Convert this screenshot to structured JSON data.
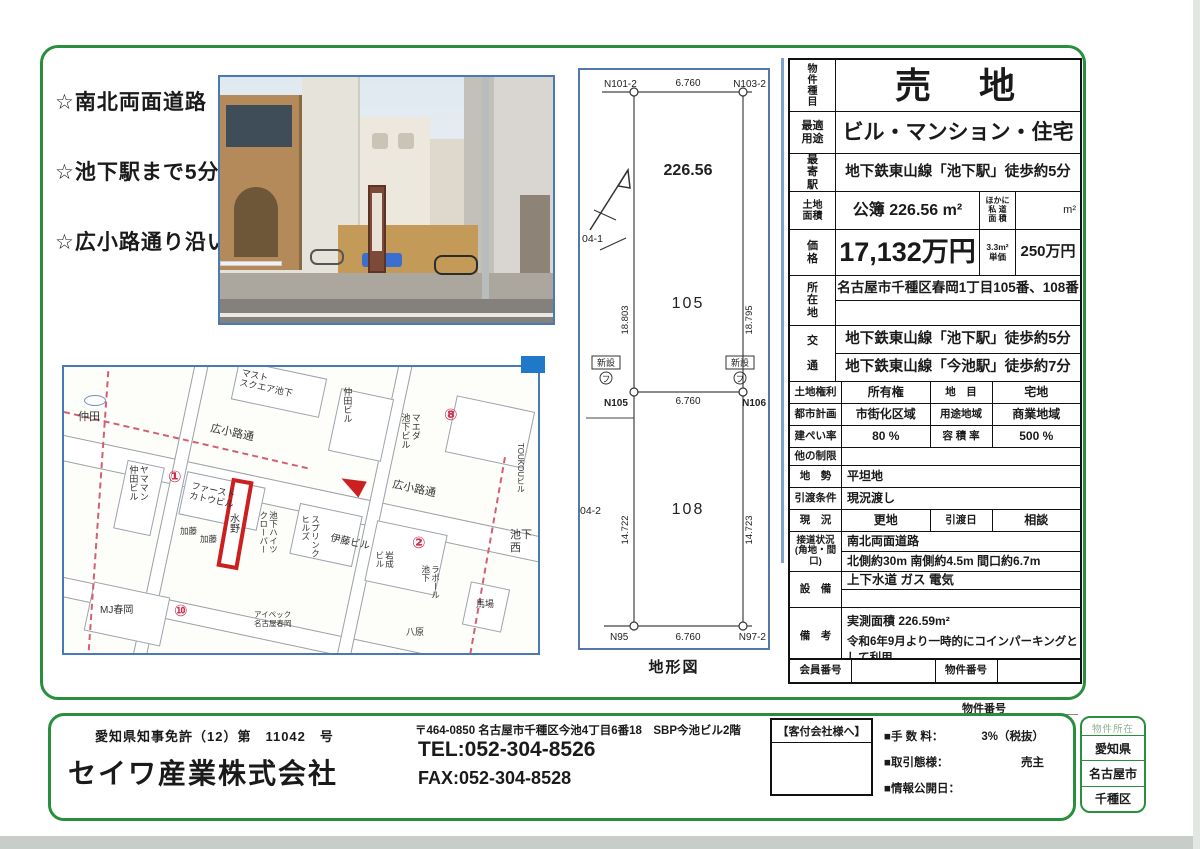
{
  "features": [
    "☆南北両面道路",
    "☆池下駅まで5分",
    "☆広小路通り沿い"
  ],
  "diagram": {
    "caption": "地形図",
    "area": "226.56",
    "lot1": "105",
    "lot2": "108",
    "n_tl": "N101-2",
    "n_tr": "N103-2",
    "n_ml": "N105",
    "n_mr": "N106",
    "n_bl": "N95",
    "n_br": "N97-2",
    "w_top": "6.760",
    "w_mid": "6.760",
    "w_bot": "6.760",
    "l1_left": "18.803",
    "l1_right": "18.795",
    "l2_left": "14.722",
    "l2_right": "14.723",
    "blk1": "04-1",
    "blk2": "04-2",
    "new1": "新設",
    "new2": "新設",
    "fu": "フ"
  },
  "map": {
    "labels": [
      {
        "t": "仲田",
        "x": 14,
        "y": 44,
        "fs": 11
      },
      {
        "t": "マスト\nスクエア池下",
        "x": 176,
        "y": 6,
        "r": 12,
        "fs": 9
      },
      {
        "t": "広小路通",
        "x": 146,
        "y": 60,
        "r": 12,
        "fs": 11
      },
      {
        "t": "仲田ビル",
        "x": 278,
        "y": 20,
        "v": 1,
        "fs": 9
      },
      {
        "t": "マエダ\n池下ビル",
        "x": 336,
        "y": 46,
        "v": 1,
        "fs": 9
      },
      {
        "t": "⑧",
        "x": 380,
        "y": 40,
        "red": 1,
        "fs": 16
      },
      {
        "t": "TOUKOUビル",
        "x": 452,
        "y": 76,
        "v": 1,
        "fs": 8
      },
      {
        "t": "広小路通",
        "x": 328,
        "y": 116,
        "r": 12,
        "fs": 11
      },
      {
        "t": "ヤママン\n仲田ビル",
        "x": 64,
        "y": 98,
        "v": 1,
        "fs": 9
      },
      {
        "t": "①",
        "x": 104,
        "y": 102,
        "red": 1,
        "fs": 16
      },
      {
        "t": "ファースト\nカトウビル",
        "x": 126,
        "y": 118,
        "r": 12,
        "fs": 9
      },
      {
        "t": "水野",
        "x": 163,
        "y": 146,
        "v": 1,
        "fs": 10
      },
      {
        "t": "池下ハイツ\nクローバー",
        "x": 194,
        "y": 144,
        "v": 1,
        "fs": 8.5
      },
      {
        "t": "スプリンク\nヒルズ",
        "x": 236,
        "y": 148,
        "v": 1,
        "fs": 8.5
      },
      {
        "t": "加藤",
        "x": 116,
        "y": 160,
        "fs": 8.5
      },
      {
        "t": "加藤",
        "x": 136,
        "y": 168,
        "fs": 8.5
      },
      {
        "t": "伊藤ビル",
        "x": 266,
        "y": 170,
        "r": 12,
        "fs": 10
      },
      {
        "t": "岩成\nビル",
        "x": 310,
        "y": 184,
        "v": 1,
        "fs": 8.5
      },
      {
        "t": "②",
        "x": 348,
        "y": 168,
        "red": 1,
        "fs": 16
      },
      {
        "t": "ラポール\n池下",
        "x": 356,
        "y": 198,
        "v": 1,
        "fs": 8.5
      },
      {
        "t": "池下西",
        "x": 446,
        "y": 162,
        "fs": 11
      },
      {
        "t": "馬場",
        "x": 412,
        "y": 232,
        "fs": 9
      },
      {
        "t": "MJ春岡",
        "x": 36,
        "y": 238,
        "fs": 10
      },
      {
        "t": "⑩",
        "x": 110,
        "y": 236,
        "red": 1,
        "fs": 16
      },
      {
        "t": "アイペック\n名古屋春岡",
        "x": 190,
        "y": 244,
        "fs": 7.5
      },
      {
        "t": "八原",
        "x": 342,
        "y": 260,
        "fs": 9
      }
    ]
  },
  "spec": {
    "type_label": "物\n件\n種\n目",
    "type": "売　地",
    "use_label": "最適\n用途",
    "use": "ビル・マンション・住宅",
    "station_label": "最\n寄\n駅",
    "station": "地下鉄東山線「池下駅」徒歩約5分",
    "area_label": "土地\n面積",
    "area": "公簿 226.56 m²",
    "area_sub_label": "ほかに\n私 道\n面 積",
    "area_sub": "m²",
    "price_label": "価\n格",
    "price": "17,132万円",
    "unit_label": "3.3m²\n単価",
    "unit_price": "250万円",
    "addr_label": "所\n在\n地",
    "addr": "名古屋市千種区春岡1丁目105番、108番",
    "access_label": "交\n\n通",
    "access1": "地下鉄東山線「池下駅」徒歩約5分",
    "access2": "地下鉄東山線「今池駅」徒歩約7分",
    "right_label": "土地権利",
    "right": "所有権",
    "chimoku_label": "地　目",
    "chimoku": "宅地",
    "plan_label": "都市計画",
    "plan": "市街化区域",
    "yoto_label": "用途地域",
    "yoto": "商業地域",
    "bpr_label": "建ぺい率",
    "bpr": "80 %",
    "floor_label": "容 積 率",
    "floor": "500 %",
    "other_label": "他の制限",
    "other": "",
    "terrain_label": "地　勢",
    "terrain": "平坦地",
    "handover_label": "引渡条件",
    "handover": "現況渡し",
    "status_label": "現　況",
    "status": "更地",
    "date_label": "引渡日",
    "date": "相談",
    "road_label": "接道状況\n(角地・間口)",
    "road1": "南北両面道路",
    "road2": "北側約30m 南側約4.5m 間口約6.7m",
    "equip_label": "設　備",
    "equip": "上下水道 ガス 電気",
    "note_label": "備　考",
    "note1": "実測面積 226.59m²",
    "note2": "令和6年9月より一時的にコインパーキングとして利用",
    "member_label": "会員番号",
    "member": "",
    "bukken_label": "物件番号",
    "bukken": ""
  },
  "footer": {
    "bukken_no_label": "物件番号",
    "license": "愛知県知事免許（12）第　11042　号",
    "company": "セイワ産業株式会社",
    "address": "〒464-0850 名古屋市千種区今池4丁目6番18　SBP今池ビル2階",
    "tel": "TEL:052-304-8526",
    "fax": "FAX:052-304-8528",
    "kyakuzuke": "【客付会社様へ】",
    "fee_label": "■手 数 料：",
    "fee_value": "3%（税抜）",
    "deal_label": "■取引態様：",
    "deal_value": "売主",
    "release_label": "■情報公開日：",
    "release_value": "",
    "location_title": "物件所在",
    "location_lines": [
      "愛知県",
      "名古屋市",
      "千種区"
    ]
  }
}
